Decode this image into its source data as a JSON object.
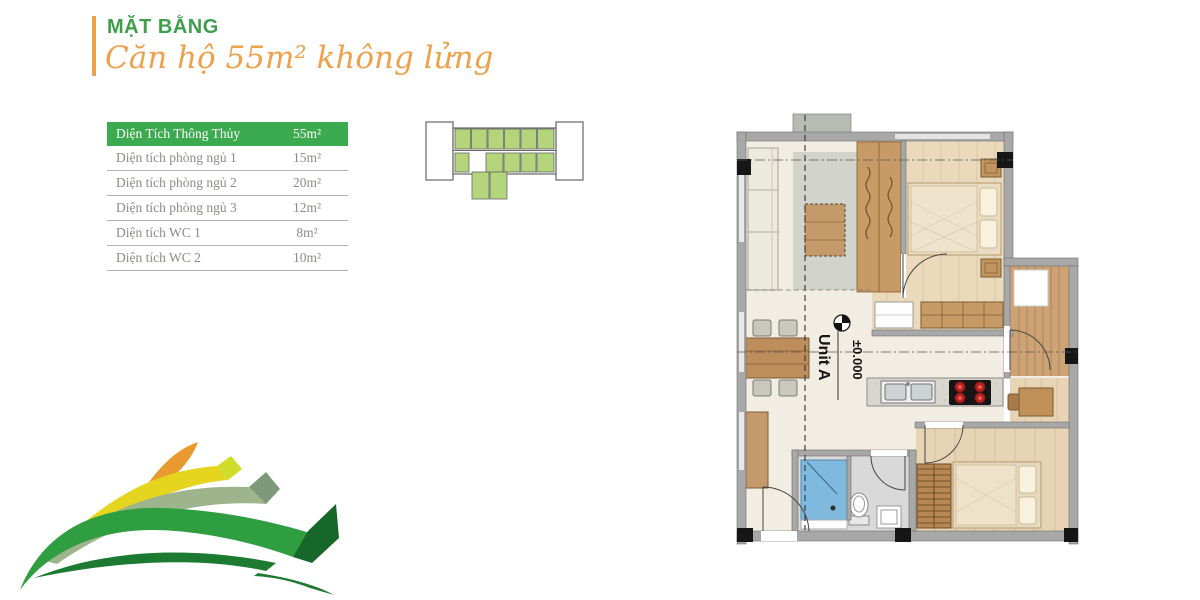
{
  "header": {
    "title": "MẶT BẰNG",
    "subtitle": "Căn hộ 55m² không lửng",
    "title_color": "#3e9e4c",
    "subtitle_color": "#efa04b",
    "accent_bar_color": "#f0a049"
  },
  "area_table": {
    "header": {
      "label": "Diện Tích Thông Thủy",
      "value": "55m²"
    },
    "rows": [
      {
        "label": "Diện tích phòng ngủ 1",
        "value": "15m²"
      },
      {
        "label": "Diện tích phòng ngủ 2",
        "value": "20m²"
      },
      {
        "label": "Diện tích phòng ngủ 3",
        "value": "12m²"
      },
      {
        "label": "Diện tích WC 1",
        "value": "8m²"
      },
      {
        "label": "Diện tích WC 2",
        "value": "10m²"
      }
    ],
    "header_bg": "#3cab4f",
    "header_text_color": "#ffffff",
    "row_text_color": "#8b8b87"
  },
  "key_plan": {
    "name": "building-key-plan",
    "highlight_color": "#b5d57c",
    "outline_color": "#666666"
  },
  "floor_plan": {
    "unit_label": "Unit A",
    "level_label": "±0.000",
    "colors": {
      "wall": "#a8a8a8",
      "floor": "#f2ede2",
      "wood_floor": "#ead9bb",
      "balcony_wood": "#cda275",
      "furniture_wood": "#c59a6b",
      "shower_blue": "#7fb9de",
      "burner_red": "#b8231f"
    }
  },
  "decoration": {
    "name": "green-ribbon-swoosh",
    "colors": [
      "#2f9e41",
      "#1d7a31",
      "#9db48c",
      "#e5d51f",
      "#e89a30"
    ]
  }
}
